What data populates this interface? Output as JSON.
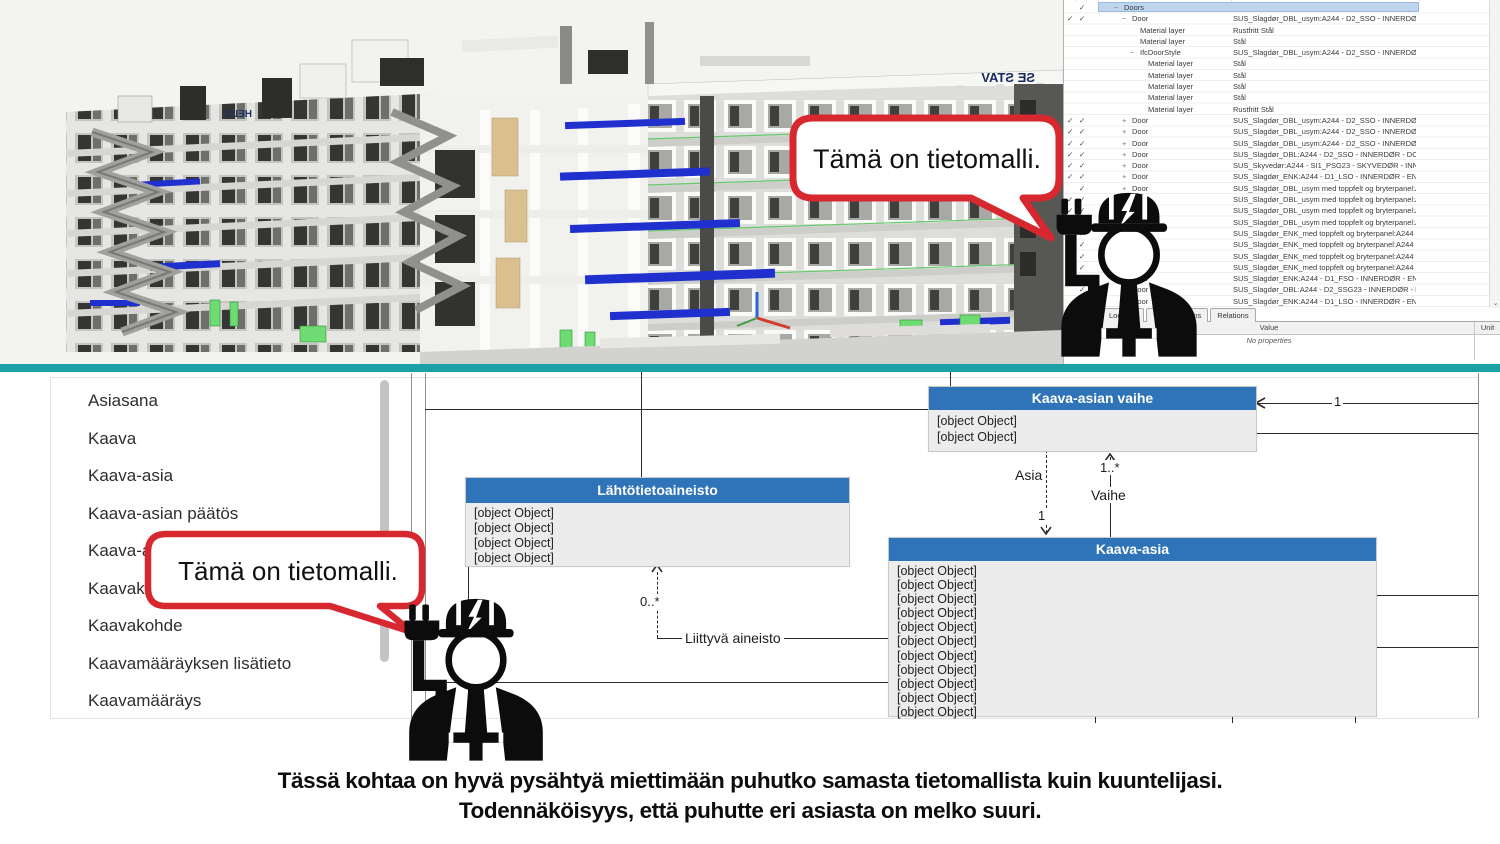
{
  "colors": {
    "divider": "#1aa2a8",
    "bubble_red": "#d7282f",
    "uml_header_blue": "#2f74b8",
    "selection_blue": "#bdd6ee"
  },
  "speech_bubbles": {
    "bim": "Tämä on tietomalli.",
    "uml": "Tämä on tietomalli."
  },
  "bim": {
    "signs": {
      "roof": "SE STAV",
      "center": "HELS"
    },
    "tree": {
      "rows": [
        {
          "ind": 0,
          "exp": "−",
          "label": "Doors",
          "value": "",
          "c1": false,
          "c2": true,
          "sel": true
        },
        {
          "ind": 1,
          "exp": "−",
          "label": "Door",
          "value": "SUS_Slagdør_DBL_usym:A244 - D2_SSO - INNERDØR  - DO...",
          "c1": true,
          "c2": true
        },
        {
          "ind": 2,
          "exp": "",
          "label": "Material layer",
          "value": "Rustfritt Stål",
          "c1": false,
          "c2": false
        },
        {
          "ind": 2,
          "exp": "",
          "label": "Material layer",
          "value": "Stål",
          "c1": false,
          "c2": false
        },
        {
          "ind": 2,
          "exp": "−",
          "label": "IfcDoorStyle",
          "value": "SUS_Slagdør_DBL_usym:A244 - D2_SSO - INNERDØR  - DO...",
          "c1": false,
          "c2": false
        },
        {
          "ind": 3,
          "exp": "",
          "label": "Material layer",
          "value": "Stål",
          "c1": false,
          "c2": false
        },
        {
          "ind": 3,
          "exp": "",
          "label": "Material layer",
          "value": "Stål",
          "c1": false,
          "c2": false
        },
        {
          "ind": 3,
          "exp": "",
          "label": "Material layer",
          "value": "Stål",
          "c1": false,
          "c2": false
        },
        {
          "ind": 3,
          "exp": "",
          "label": "Material layer",
          "value": "Stål",
          "c1": false,
          "c2": false
        },
        {
          "ind": 3,
          "exp": "",
          "label": "Material layer",
          "value": "Rustfritt Stål",
          "c1": false,
          "c2": false
        },
        {
          "ind": 1,
          "exp": "+",
          "label": "Door",
          "value": "SUS_Slagdør_DBL_usym:A244 - D2_SSO - INNERDØR  - DO...",
          "c1": true,
          "c2": true
        },
        {
          "ind": 1,
          "exp": "+",
          "label": "Door",
          "value": "SUS_Slagdør_DBL_usym:A244 - D2_SSO - INNERDØR  - DO...",
          "c1": true,
          "c2": true
        },
        {
          "ind": 1,
          "exp": "+",
          "label": "Door",
          "value": "SUS_Slagdør_DBL_usym:A244 - D2_SSO - INNERDØR  - DO...",
          "c1": true,
          "c2": true
        },
        {
          "ind": 1,
          "exp": "+",
          "label": "Door",
          "value": "SUS_Slagdør_DBL:A244 - D2_SSO - INNERDØR - DOBBEL - ...",
          "c1": true,
          "c2": true
        },
        {
          "ind": 1,
          "exp": "+",
          "label": "Door",
          "value": "SUS_Skyvedør:A244 - SI1_PSG23 - SKYVEDØR - INNERDØR...",
          "c1": true,
          "c2": true
        },
        {
          "ind": 1,
          "exp": "+",
          "label": "Door",
          "value": "SUS_Slagdør_ENK:A244 - D1_LSO - INNERDØR  - ENKEL - 1...",
          "c1": true,
          "c2": true
        },
        {
          "ind": 1,
          "exp": "+",
          "label": "Door",
          "value": "SUS_Slagdør_DBL_usym med toppfelt og bryterpanel:A244 ...",
          "c1": false,
          "c2": true
        },
        {
          "ind": 1,
          "exp": "+",
          "label": "Door",
          "value": "SUS_Slagdør_DBL_usym med toppfelt og bryterpanel:A244 ...",
          "c1": true,
          "c2": true
        },
        {
          "ind": 1,
          "exp": "+",
          "label": "Door",
          "value": "SUS_Slagdør_DBL_usym med toppfelt og bryterpanel:A244 ...",
          "c1": true,
          "c2": true
        },
        {
          "ind": 1,
          "exp": "+",
          "label": "Door",
          "value": "SUS_Slagdør_DBL_usym med toppfelt og bryterpanel:A244 ...",
          "c1": false,
          "c2": true
        },
        {
          "ind": 1,
          "exp": "+",
          "label": "Door",
          "value": "SUS_Slagdør_ENK_med toppfelt og bryterpanel:A244 - D1_...",
          "c1": true,
          "c2": true
        },
        {
          "ind": 1,
          "exp": "+",
          "label": "Door",
          "value": "SUS_Slagdør_ENK_med toppfelt og bryterpanel:A244 - D1_...",
          "c1": false,
          "c2": true
        },
        {
          "ind": 1,
          "exp": "+",
          "label": "Door",
          "value": "SUS_Slagdør_ENK_med toppfelt og bryterpanel:A244 - D1_...",
          "c1": false,
          "c2": true
        },
        {
          "ind": 1,
          "exp": "+",
          "label": "Door",
          "value": "SUS_Slagdør_ENK_med toppfelt og bryterpanel:A244 - D1_...",
          "c1": false,
          "c2": true
        },
        {
          "ind": 1,
          "exp": "+",
          "label": "Door",
          "value": "SUS_Slagdør_ENK:A244 - D1_FSO - INNERDØR  - ENKEL - B...",
          "c1": false,
          "c2": true
        },
        {
          "ind": 1,
          "exp": "+",
          "label": "Door",
          "value": "SUS_Slagdør_DBL:A244 - D2_SSG23 - INNERDØR - DOBBEL...",
          "c1": false,
          "c2": true
        },
        {
          "ind": 1,
          "exp": "+",
          "label": "Door",
          "value": "SUS_Slagdør_ENK:A244 - D1_LSO - INNERDØR  - ENKEL - 1...",
          "c1": false,
          "c2": true
        }
      ]
    },
    "tabs": [
      {
        "label": "Location"
      },
      {
        "label": "Classifications"
      },
      {
        "label": "Relations"
      }
    ],
    "props_table": {
      "value_header": "Value",
      "unit_header": "Unit",
      "empty_text": "No properties"
    }
  },
  "uml": {
    "list_items": [
      {
        "label": "Asiasana"
      },
      {
        "label": "Kaava"
      },
      {
        "label": "Kaava-asia"
      },
      {
        "label": "Kaava-asian päätös"
      },
      {
        "label": "Kaava-a"
      },
      {
        "label": "Kaavaka"
      },
      {
        "label": "Kaavakohde"
      },
      {
        "label": "Kaavamääräyksen lisätieto"
      },
      {
        "label": "Kaavamääräys"
      }
    ],
    "classes": [
      {
        "title": "Kaava-asian vaihe",
        "attrs": [
          "- Elinkaaren tila : Literaali [1]",
          "- Kaava-asian vaiheen avain : Teksti [1]"
        ]
      },
      {
        "title": "Lähtötietoaineisto",
        "attrs": [
          "- Nimi : Kieliversioitu teksti [0..1]",
          "- Lähtötietoaineiston laji : Literaali [1]",
          "- Lisätietolinkki : URI [0..1]",
          "- Lähtötietoaineiston avain : Teksti [1]"
        ]
      },
      {
        "title": "Kaava-asia",
        "attrs": [
          "- Kaavalaji : Literaali [1]",
          "- Pysyvä kaavatunnus : URI [1]",
          "- Tuottajan kaavatunnus : URI [0..1]",
          "- Nimi : Kieliversioitu teksti [1]",
          "- Kuvaus : Kieliversioitu teksti [0..*]",
          "- Asianhallintatunnus : Teksti [0..*]",
          "- Diaarinumero : Teksti [0..*]",
          "- Vireilletulopäivämäärä : Päivämäärä [1]",
          "- Digitaalinen alkuperä : Literaali [0..1]",
          "- Hallinnollisen alueen tunnus : Literaali [1]",
          "- Pysyvä sitovan tonttijaon tunnus : URI [0..1]"
        ]
      }
    ],
    "edge_labels": {
      "right_mult": "1",
      "asia": "Asia",
      "asia_mult": "1",
      "vaihe": "Vaihe",
      "vaihe_mult": "1..*",
      "aineisto_mult": "0..*",
      "aineisto_role": "Liittyvä aineisto"
    }
  },
  "caption": {
    "line1": "Tässä kohtaa on hyvä pysähtyä miettimään puhutko samasta tietomallista kuin kuuntelijasi.",
    "line2": "Todennäköisyys, että puhutte eri asiasta on melko suuri."
  }
}
